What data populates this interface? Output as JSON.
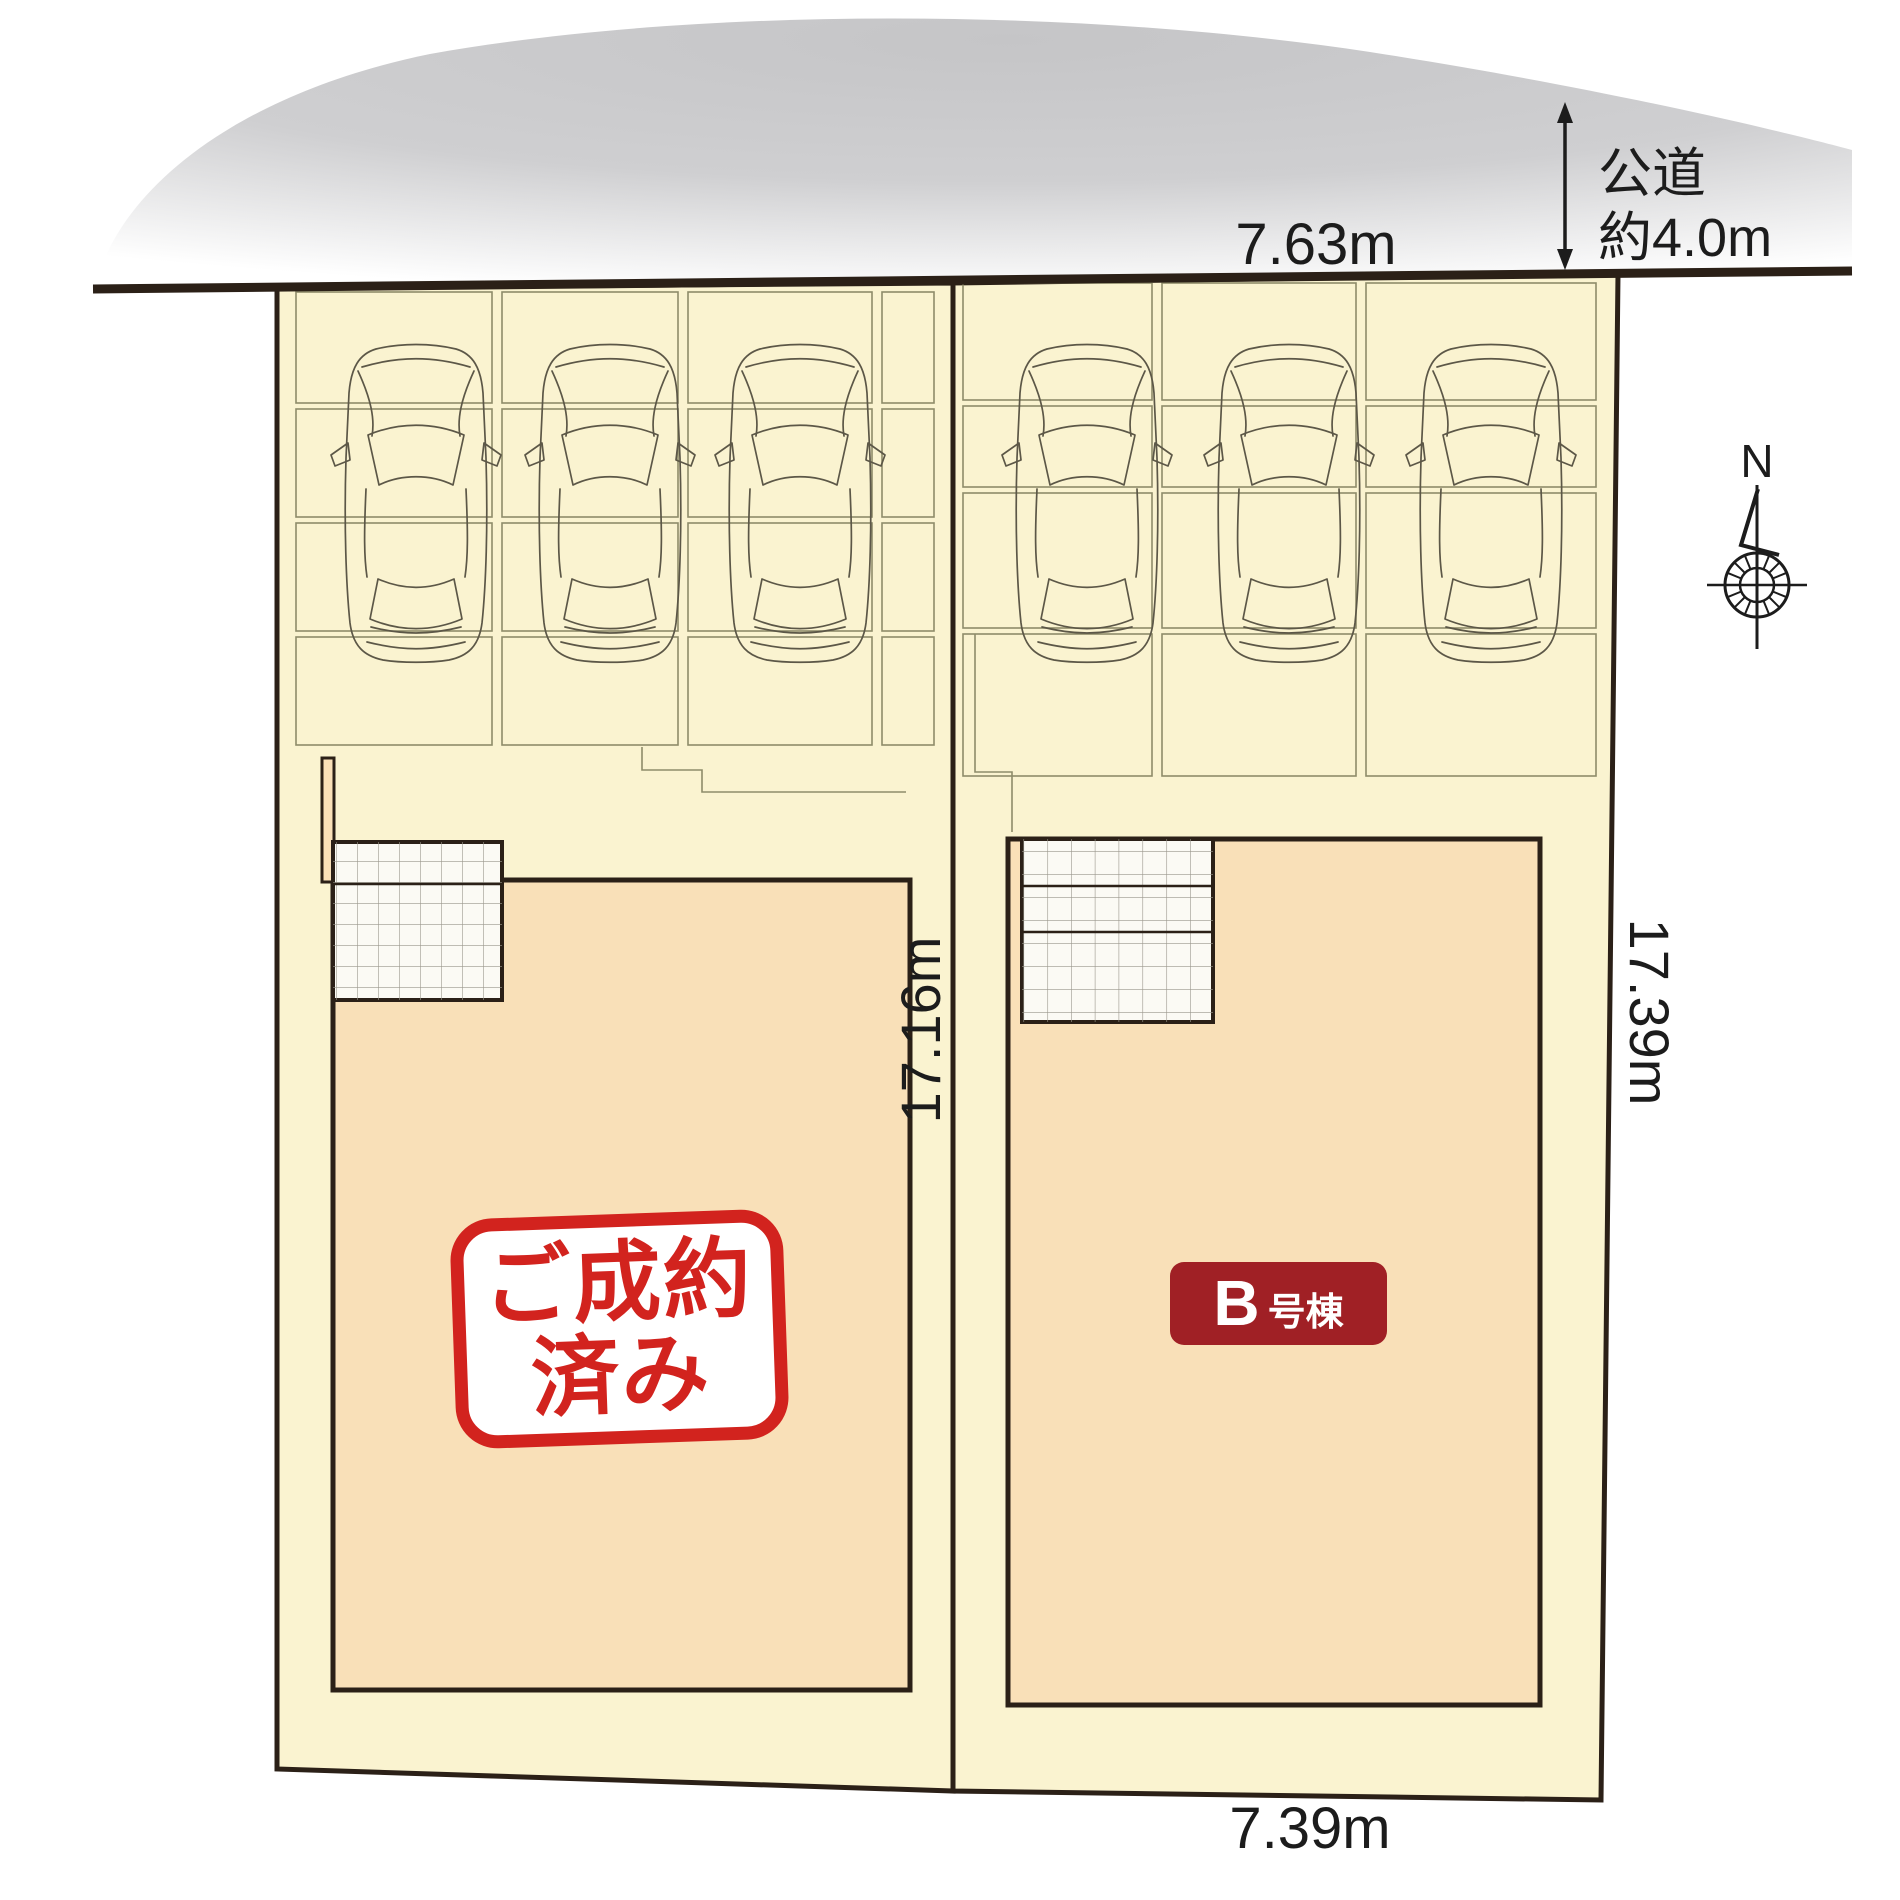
{
  "plan": {
    "road_label_line1": "公道",
    "road_label_line2": "約4.0m",
    "dim_top_width": "7.63m",
    "dim_bottom_width": "7.39m",
    "dim_left_depth": "17.16m",
    "dim_right_depth": "17.39m",
    "compass_north": "N"
  },
  "lots": {
    "left": {
      "status_stamp_line1": "ご成約",
      "status_stamp_line2": "済み"
    },
    "right": {
      "badge_letter": "B",
      "badge_suffix": "号棟"
    }
  },
  "colors": {
    "cream": "#faf3d0",
    "lot_outline": "#2b2017",
    "building_fill": "#f9e0b8",
    "slab_outline": "#8e8c6a",
    "car_outline": "#5c5747",
    "porch_grid": "#9a978c",
    "road_dark": "#2b2017",
    "cloud_gray": "#c8c8ca",
    "stamp_red": "#d2231e",
    "badge_red": "#a02025",
    "text_dark": "#1c1c1c",
    "porch_fill": "#fbfaf4"
  }
}
